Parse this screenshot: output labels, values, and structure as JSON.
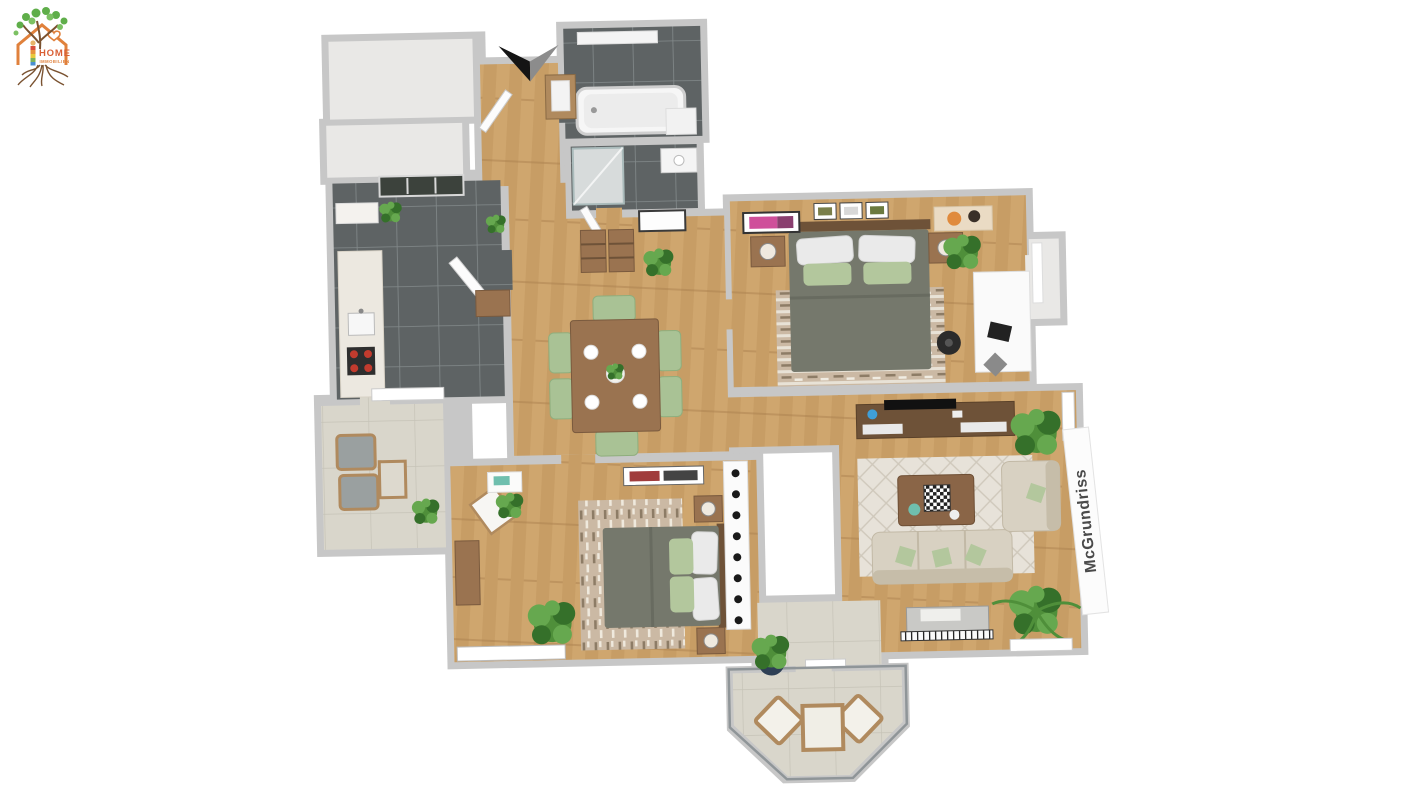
{
  "page": {
    "background": "#ffffff",
    "width": 1422,
    "height": 800
  },
  "logo": {
    "title": "HOME",
    "subtitle": "IMMOBILIEN"
  },
  "watermark": {
    "text": "McGrundriss"
  },
  "icons": {
    "entrance_arrow": "chevron-down"
  },
  "colors": {
    "wall": "#c7c7c7",
    "wall_light": "#e9e8e6",
    "wood": "#cfa66e",
    "wood_dark": "#c0945c",
    "tile_dark": "#5e6364",
    "tile_dark_line": "#838a8b",
    "tile_light": "#d9d6cb",
    "tile_light_line": "#c6c3b7",
    "bed_gray": "#75786c",
    "pillow_green": "#b3c79d",
    "pillow_white": "#eaeaea",
    "sofa_beige": "#d8d1c2",
    "sofa_shadow": "#c6bda9",
    "rug_light": "#e7e2d9",
    "rug_line": "#cfc8bb",
    "rug_tan": "#cbb9a4",
    "rug_dash": "#8d7c66",
    "wood_furniture": "#9a7350",
    "wood_furniture_dark": "#6e5238",
    "chair_green": "#a9c295",
    "plant_green": "#4f8f3a",
    "plant_light": "#66a84f",
    "plant_dark": "#35702a",
    "black": "#1a1a1a",
    "white": "#ffffff",
    "logo_orange": "#e0813c",
    "logo_text": "#d95f35",
    "logo_green": "#5fae4a",
    "logo_brown": "#7a5230",
    "watermark_gray": "#4a4a4a",
    "art_pink": "#cf4f9a",
    "stove_red": "#c23b2e",
    "deco_blue": "#3f9fd8",
    "deco_teal": "#6fbfae",
    "railing": "#8f9598"
  }
}
